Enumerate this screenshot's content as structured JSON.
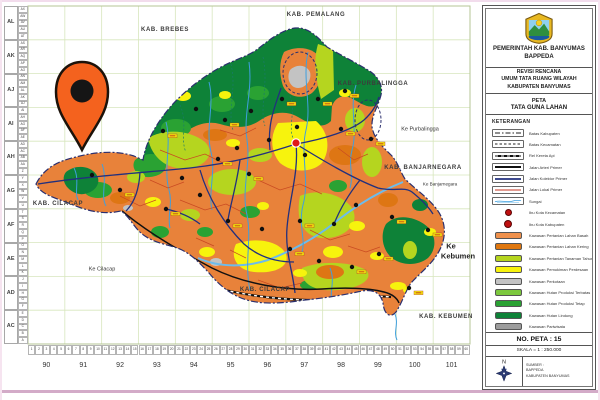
{
  "window": {
    "frame_top_color": "#f2dcec",
    "frame_bottom_color": "#d3abc8",
    "frame_side_color": "#f6e4f0"
  },
  "map": {
    "colors": {
      "grid": "#d7e6bd",
      "base": "#e8823a",
      "dorange": "#de7614",
      "lime": "#b5d51f",
      "yellow": "#f7f30d",
      "lgreen": "#7cc83e",
      "green": "#2aa233",
      "dgreen": "#0e8238",
      "lgray": "#c3c3c3",
      "gray": "#9c9c9c",
      "river": "#3f9fde",
      "river2": "#6cbcec",
      "navy": "#22307e",
      "red": "#c94a22",
      "boundary": "#2b2f6e",
      "pin": "#f4621e",
      "capital": "#e01818"
    },
    "grid": {
      "col_labels": [
        "90",
        "91",
        "92",
        "93",
        "94",
        "95",
        "96",
        "97",
        "98",
        "99",
        "100",
        "101"
      ],
      "row_labels": [
        "AL",
        "AK",
        "AJ",
        "AI",
        "AH",
        "AG",
        "AF",
        "AE",
        "AD",
        "AC"
      ],
      "minor_col_labels": [
        "1",
        "2",
        "3",
        "4",
        "5",
        "6",
        "7",
        "8",
        "9",
        "10",
        "11",
        "12",
        "13",
        "14",
        "15",
        "16",
        "17",
        "18",
        "19",
        "20",
        "21",
        "22",
        "23",
        "24",
        "25",
        "26",
        "27",
        "28",
        "29",
        "30",
        "31",
        "32",
        "33",
        "34",
        "35",
        "36",
        "37",
        "38",
        "39",
        "40",
        "41",
        "42",
        "43",
        "44",
        "45",
        "46",
        "47",
        "48",
        "49",
        "50",
        "51",
        "52",
        "53",
        "54",
        "55",
        "56",
        "57",
        "58",
        "59",
        "60"
      ],
      "minor_row_labels": [
        "AX",
        "AW",
        "AV",
        "AU",
        "AT",
        "AS",
        "AR",
        "AQ",
        "AP",
        "AO",
        "AN",
        "AM",
        "AL",
        "AK",
        "AJ",
        "AI",
        "AH",
        "AG",
        "AF",
        "AE",
        "AD",
        "AC",
        "AB",
        "AA",
        "Z",
        "Y",
        "X",
        "W",
        "V",
        "U",
        "T",
        "S",
        "R",
        "Q",
        "P",
        "O",
        "N",
        "M",
        "L",
        "K",
        "J",
        "I",
        "H",
        "G",
        "F",
        "E",
        "D",
        "C",
        "B",
        "A"
      ]
    },
    "region_labels": [
      {
        "text": "KAB. BREBES",
        "x": 165,
        "y": 30,
        "cls": "kab"
      },
      {
        "text": "KAB. PEMALANG",
        "x": 316,
        "y": 15,
        "cls": "kab"
      },
      {
        "text": "KAB. PURBALINGGA",
        "x": 373,
        "y": 84,
        "cls": "kab"
      },
      {
        "text": "Ke Purbalingga",
        "x": 420,
        "y": 130,
        "cls": "ke"
      },
      {
        "text": "KAB. BANJARNEGARA",
        "x": 423,
        "y": 168,
        "cls": "kab"
      },
      {
        "text": "Ke Banjarnegara",
        "x": 440,
        "y": 185,
        "cls": "kesm"
      },
      {
        "text": "Ke",
        "x": 451,
        "y": 246,
        "cls": "kebig"
      },
      {
        "text": "Kebumen",
        "x": 458,
        "y": 256,
        "cls": "kebig"
      },
      {
        "text": "KAB. KEBUMEN",
        "x": 446,
        "y": 317,
        "cls": "kab"
      },
      {
        "text": "KAB. CILACAP",
        "x": 58,
        "y": 204,
        "cls": "kab"
      },
      {
        "text": "Ke Cilacap",
        "x": 102,
        "y": 270,
        "cls": "ke"
      },
      {
        "text": "KAB. CILACAP",
        "x": 265,
        "y": 290,
        "cls": "kab"
      }
    ],
    "town_dots": [
      [
        163,
        131
      ],
      [
        196,
        109
      ],
      [
        225,
        120
      ],
      [
        251,
        111
      ],
      [
        282,
        99
      ],
      [
        318,
        99
      ],
      [
        345,
        91
      ],
      [
        297,
        127
      ],
      [
        341,
        129
      ],
      [
        371,
        139
      ],
      [
        218,
        159
      ],
      [
        249,
        174
      ],
      [
        200,
        195
      ],
      [
        166,
        209
      ],
      [
        228,
        221
      ],
      [
        262,
        229
      ],
      [
        300,
        221
      ],
      [
        334,
        224
      ],
      [
        290,
        249
      ],
      [
        319,
        261
      ],
      [
        352,
        267
      ],
      [
        379,
        254
      ],
      [
        120,
        190
      ],
      [
        92,
        175
      ],
      [
        409,
        288
      ],
      [
        392,
        217
      ],
      [
        428,
        230
      ],
      [
        305,
        155
      ],
      [
        269,
        140
      ],
      [
        237,
        148
      ],
      [
        356,
        205
      ],
      [
        182,
        178
      ]
    ],
    "name_chips": [
      [
        168,
        134
      ],
      [
        230,
        123
      ],
      [
        287,
        102
      ],
      [
        323,
        102
      ],
      [
        350,
        94
      ],
      [
        346,
        132
      ],
      [
        376,
        142
      ],
      [
        223,
        162
      ],
      [
        254,
        177
      ],
      [
        171,
        212
      ],
      [
        233,
        224
      ],
      [
        305,
        224
      ],
      [
        295,
        252
      ],
      [
        357,
        270
      ],
      [
        384,
        257
      ],
      [
        414,
        291
      ],
      [
        397,
        220
      ],
      [
        433,
        233
      ],
      [
        125,
        193
      ]
    ],
    "capital_dot": [
      296,
      143
    ]
  },
  "panel": {
    "header": {
      "line1": "PEMERINTAH KAB. BANYUMAS",
      "line2": "BAPPEDA"
    },
    "subtitle_lines": [
      "REVISI RENCANA",
      "UMUM TATA RUANG WILAYAH",
      "KABUPATEN BANYUMAS"
    ],
    "map_label": "PETA",
    "map_name": "TATA GUNA LAHAN",
    "legend_title": "KETERANGAN",
    "legend_lines": [
      {
        "label": "Batas Kabupaten",
        "style": "dashdot"
      },
      {
        "label": "Batas Kecamatan",
        "style": "dashed"
      },
      {
        "label": "Rel Kereta Api",
        "style": "rail"
      },
      {
        "label": "Jalan Arteri Primer",
        "style": "solid-thick"
      },
      {
        "label": "Jalan Kolektor Primer",
        "style": "solid-navy"
      },
      {
        "label": "Jalan Lokal Primer",
        "style": "solid-red"
      },
      {
        "label": "Sungai",
        "style": "river"
      }
    ],
    "legend_points": [
      {
        "label": "Ibu Kota Kecamatan",
        "size": 5
      },
      {
        "label": "Ibu Kota Kabupaten",
        "size": 6.5
      }
    ],
    "legend_areas": [
      {
        "label": "Kawasan Pertanian Lahan Basah",
        "color": "#f0914c"
      },
      {
        "label": "Kawasan Pertanian Lahan Kering",
        "color": "#e0770f"
      },
      {
        "label": "Kawasan Pertanian Tanaman Tahunan",
        "color": "#b5d51f"
      },
      {
        "label": "Kawasan Pemukiman Perdesaan",
        "color": "#f7f30d"
      },
      {
        "label": "Kawasan Perkotaan",
        "color": "#c3c3c3"
      },
      {
        "label": "Kawasan Hutan Produksi Terbatas",
        "color": "#7cc83e"
      },
      {
        "label": "Kawasan Hutan Produksi Tetap",
        "color": "#2aa233"
      },
      {
        "label": "Kawasan Hutan Lindung",
        "color": "#0e8238"
      },
      {
        "label": "Kawasan Pariwisata",
        "color": "#9c9c9c"
      }
    ],
    "map_no": "NO. PETA : 15",
    "scale": "SKALA = 1 : 250.000",
    "north_label": "N",
    "source_lines": [
      "SUMBER :",
      "BAPPEDA",
      "KABUPATEN BANYUMAS"
    ]
  }
}
